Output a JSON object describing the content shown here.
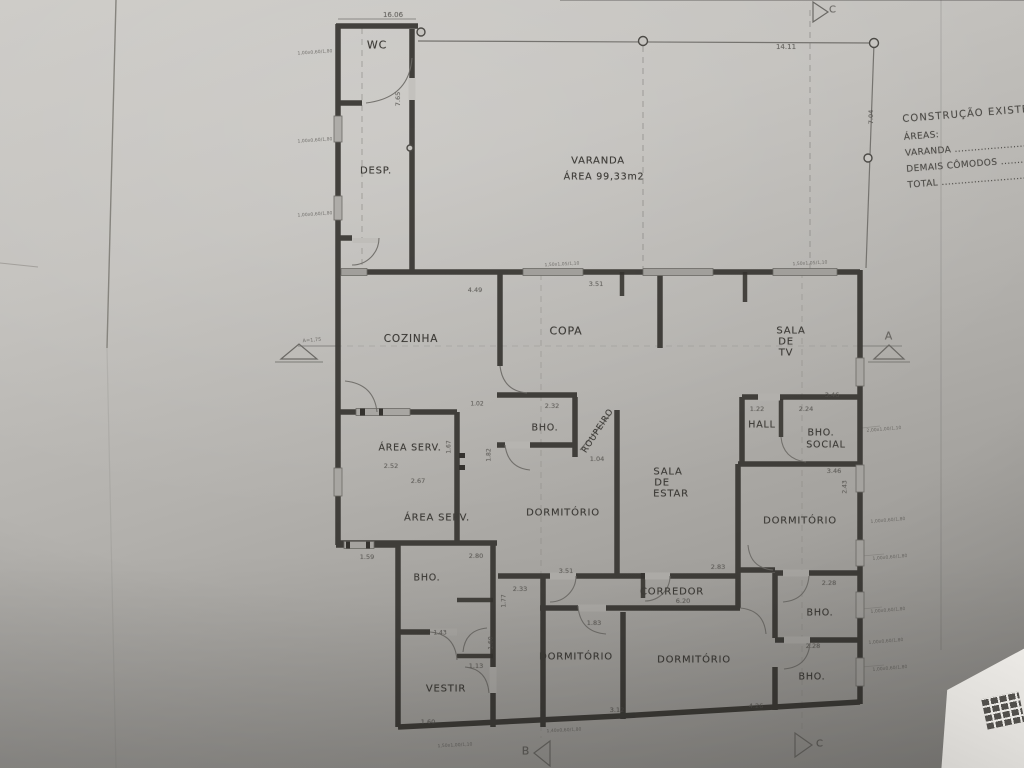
{
  "photo": {
    "subject": "architectural floor plan photographed on gray paper",
    "paper_color": "#b3b1ad",
    "wall_color": "#34322e",
    "white_corner_color": "#ece9e5"
  },
  "notes": {
    "title": "CONSTRUÇÃO EXISTENTE",
    "areas_label": "ÁREAS:",
    "line_varanda": "VARANDA .........................................",
    "line_demais": "DEMAIS CÔMODOS ..................",
    "line_total": "TOTAL ..............................................."
  },
  "labels": [
    {
      "text": "WC",
      "x": 377,
      "y": 45,
      "size": 11,
      "cls": "room",
      "name": "room-label-wc"
    },
    {
      "text": "DESP.",
      "x": 376,
      "y": 171,
      "size": 10,
      "cls": "room",
      "name": "room-label-desp"
    },
    {
      "text": "VARANDA",
      "x": 598,
      "y": 161,
      "size": 10,
      "cls": "room",
      "name": "room-label-varanda"
    },
    {
      "text": "ÁREA 99,33m2",
      "x": 604,
      "y": 177,
      "size": 9.5,
      "cls": "room",
      "name": "varanda-area-value"
    },
    {
      "text": "COZINHA",
      "x": 411,
      "y": 339,
      "size": 10.5,
      "cls": "room",
      "name": "room-label-cozinha"
    },
    {
      "text": "COPA",
      "x": 566,
      "y": 331,
      "size": 11,
      "cls": "room",
      "name": "room-label-copa"
    },
    {
      "text": "SALA",
      "x": 791,
      "y": 331,
      "size": 10,
      "cls": "room",
      "name": "room-label-sala-de-tv"
    },
    {
      "text": "DE",
      "x": 786,
      "y": 342,
      "size": 10,
      "cls": "room",
      "name": "room-label-sala-de-tv"
    },
    {
      "text": "TV",
      "x": 786,
      "y": 353,
      "size": 10,
      "cls": "room",
      "name": "room-label-sala-de-tv"
    },
    {
      "text": "ÁREA SERV.",
      "x": 410,
      "y": 448,
      "size": 9.5,
      "cls": "room",
      "name": "room-label-area-serv-1"
    },
    {
      "text": "BHO.",
      "x": 545,
      "y": 428,
      "size": 9.5,
      "cls": "room",
      "name": "room-label-bho-1"
    },
    {
      "text": "ROUPEIRO",
      "x": 598,
      "y": 431,
      "size": 8.5,
      "rot": -57,
      "cls": "room",
      "name": "room-label-roupeiro"
    },
    {
      "text": "HALL",
      "x": 762,
      "y": 425,
      "size": 9.5,
      "cls": "room",
      "name": "room-label-hall"
    },
    {
      "text": "BHO.",
      "x": 821,
      "y": 433,
      "size": 9.5,
      "cls": "room",
      "name": "room-label-bho-social"
    },
    {
      "text": "SOCIAL",
      "x": 826,
      "y": 445,
      "size": 9.5,
      "cls": "room",
      "name": "room-label-bho-social"
    },
    {
      "text": "SALA",
      "x": 668,
      "y": 472,
      "size": 10,
      "cls": "room",
      "name": "room-label-sala-de-estar"
    },
    {
      "text": "DE",
      "x": 662,
      "y": 483,
      "size": 10,
      "cls": "room",
      "name": "room-label-sala-de-estar"
    },
    {
      "text": "ESTAR",
      "x": 671,
      "y": 494,
      "size": 10,
      "cls": "room",
      "name": "room-label-sala-de-estar"
    },
    {
      "text": "ÁREA SERV.",
      "x": 437,
      "y": 518,
      "size": 10,
      "cls": "room",
      "name": "room-label-area-serv-2"
    },
    {
      "text": "DORMITÓRIO",
      "x": 563,
      "y": 513,
      "size": 10,
      "cls": "room",
      "name": "room-label-dormitorio-1"
    },
    {
      "text": "DORMITÓRIO",
      "x": 800,
      "y": 521,
      "size": 10,
      "cls": "room",
      "name": "room-label-dormitorio-2"
    },
    {
      "text": "BHO.",
      "x": 427,
      "y": 578,
      "size": 9.5,
      "cls": "room",
      "name": "room-label-bho-2"
    },
    {
      "text": "CORREDOR",
      "x": 672,
      "y": 592,
      "size": 10,
      "cls": "room",
      "name": "room-label-corredor"
    },
    {
      "text": "DORMITÓRIO",
      "x": 576,
      "y": 657,
      "size": 10,
      "cls": "room",
      "name": "room-label-dormitorio-3"
    },
    {
      "text": "DORMITÓRIO",
      "x": 694,
      "y": 660,
      "size": 10,
      "cls": "room",
      "name": "room-label-dormitorio-4"
    },
    {
      "text": "BHO.",
      "x": 820,
      "y": 613,
      "size": 9.5,
      "cls": "room",
      "name": "room-label-bho-3"
    },
    {
      "text": "BHO.",
      "x": 812,
      "y": 677,
      "size": 9.5,
      "cls": "room",
      "name": "room-label-bho-4"
    },
    {
      "text": "VESTIR",
      "x": 446,
      "y": 689,
      "size": 10,
      "cls": "room",
      "name": "room-label-vestir"
    },
    {
      "text": "16.06",
      "x": 393,
      "y": 15,
      "size": 7,
      "cls": "dim",
      "name": "dimension-label"
    },
    {
      "text": "7.65",
      "x": 398,
      "y": 99,
      "size": 6.5,
      "rot": -90,
      "cls": "dim",
      "name": "dimension-label"
    },
    {
      "text": "14.11",
      "x": 786,
      "y": 47,
      "size": 7,
      "cls": "dim",
      "name": "dimension-label"
    },
    {
      "text": "7.04",
      "x": 871,
      "y": 117,
      "size": 6.5,
      "rot": -90,
      "cls": "dim",
      "name": "dimension-label"
    },
    {
      "text": "4.49",
      "x": 475,
      "y": 290,
      "size": 6.5,
      "cls": "dim",
      "name": "dimension-label"
    },
    {
      "text": "3.51",
      "x": 596,
      "y": 284,
      "size": 6.5,
      "cls": "dim",
      "name": "dimension-label"
    },
    {
      "text": "2.32",
      "x": 552,
      "y": 406,
      "size": 6.5,
      "cls": "dim",
      "name": "dimension-label"
    },
    {
      "text": "1.04",
      "x": 597,
      "y": 459,
      "size": 6.5,
      "cls": "dim",
      "name": "dimension-label"
    },
    {
      "text": "1.02",
      "x": 477,
      "y": 404,
      "size": 6,
      "cls": "dim",
      "name": "dimension-label"
    },
    {
      "text": "1.82",
      "x": 489,
      "y": 455,
      "size": 6,
      "rot": -90,
      "cls": "dim",
      "name": "dimension-label"
    },
    {
      "text": "1.67",
      "x": 449,
      "y": 447,
      "size": 6,
      "rot": -90,
      "cls": "dim",
      "name": "dimension-label"
    },
    {
      "text": "2.52",
      "x": 391,
      "y": 466,
      "size": 6.5,
      "cls": "dim",
      "name": "dimension-label"
    },
    {
      "text": "2.67",
      "x": 418,
      "y": 481,
      "size": 6.5,
      "cls": "dim",
      "name": "dimension-label"
    },
    {
      "text": "1.22",
      "x": 757,
      "y": 409,
      "size": 6.5,
      "cls": "dim",
      "name": "dimension-label"
    },
    {
      "text": "2.24",
      "x": 806,
      "y": 409,
      "size": 6.5,
      "cls": "dim",
      "name": "dimension-label"
    },
    {
      "text": "3.46",
      "x": 832,
      "y": 395,
      "size": 6.5,
      "cls": "dim",
      "name": "dimension-label"
    },
    {
      "text": "3.46",
      "x": 834,
      "y": 471,
      "size": 6.5,
      "cls": "dim",
      "name": "dimension-label"
    },
    {
      "text": "2.83",
      "x": 718,
      "y": 567,
      "size": 6.5,
      "cls": "dim",
      "name": "dimension-label"
    },
    {
      "text": "2.80",
      "x": 476,
      "y": 556,
      "size": 6.5,
      "cls": "dim",
      "name": "dimension-label"
    },
    {
      "text": "3.51",
      "x": 566,
      "y": 571,
      "size": 6.5,
      "cls": "dim",
      "name": "dimension-label"
    },
    {
      "text": "2.33",
      "x": 520,
      "y": 589,
      "size": 6.5,
      "cls": "dim",
      "name": "dimension-label"
    },
    {
      "text": "1.77",
      "x": 504,
      "y": 601,
      "size": 6,
      "rot": -90,
      "cls": "dim",
      "name": "dimension-label"
    },
    {
      "text": "1.83",
      "x": 594,
      "y": 623,
      "size": 6.5,
      "cls": "dim",
      "name": "dimension-label"
    },
    {
      "text": "6.20",
      "x": 683,
      "y": 601,
      "size": 6.5,
      "cls": "dim",
      "name": "dimension-label"
    },
    {
      "text": "2.28",
      "x": 829,
      "y": 583,
      "size": 6.5,
      "cls": "dim",
      "name": "dimension-label"
    },
    {
      "text": "2.28",
      "x": 813,
      "y": 646,
      "size": 6.5,
      "cls": "dim",
      "name": "dimension-label"
    },
    {
      "text": "4.26",
      "x": 756,
      "y": 706,
      "size": 6.5,
      "cls": "dim",
      "name": "dimension-label"
    },
    {
      "text": "3.12",
      "x": 617,
      "y": 710,
      "size": 6.5,
      "cls": "dim",
      "name": "dimension-label"
    },
    {
      "text": "1.13",
      "x": 476,
      "y": 666,
      "size": 6.5,
      "cls": "dim",
      "name": "dimension-label"
    },
    {
      "text": "1.60",
      "x": 491,
      "y": 643,
      "size": 6,
      "rot": -90,
      "cls": "dim",
      "name": "dimension-label"
    },
    {
      "text": "1.43",
      "x": 440,
      "y": 633,
      "size": 6,
      "cls": "dim",
      "name": "dimension-label"
    },
    {
      "text": "1.59",
      "x": 367,
      "y": 557,
      "size": 6.5,
      "cls": "dim",
      "name": "dimension-label"
    },
    {
      "text": "1.60",
      "x": 428,
      "y": 722,
      "size": 6.5,
      "cls": "dim",
      "name": "dimension-label"
    },
    {
      "text": "2.43",
      "x": 845,
      "y": 487,
      "size": 6,
      "rot": -90,
      "cls": "dim",
      "name": "dimension-label"
    },
    {
      "text": "1,00x0,60/1,80",
      "x": 315,
      "y": 52,
      "size": 8,
      "sc": 0.55,
      "rot": -4,
      "cls": "ann",
      "name": "window-annotation"
    },
    {
      "text": "1,00x0,60/1,80",
      "x": 315,
      "y": 140,
      "size": 8,
      "sc": 0.55,
      "rot": -4,
      "cls": "ann",
      "name": "window-annotation"
    },
    {
      "text": "1,00x0,60/1,80",
      "x": 315,
      "y": 214,
      "size": 8,
      "sc": 0.55,
      "rot": -4,
      "cls": "ann",
      "name": "window-annotation"
    },
    {
      "text": "1,50x1,05/1,10",
      "x": 562,
      "y": 264,
      "size": 8,
      "sc": 0.55,
      "rot": -3,
      "cls": "ann",
      "name": "window-annotation"
    },
    {
      "text": "1,50x1,05/1,10",
      "x": 810,
      "y": 263,
      "size": 8,
      "sc": 0.55,
      "rot": -3,
      "cls": "ann",
      "name": "window-annotation"
    },
    {
      "text": "2,00x1,00/1,10",
      "x": 884,
      "y": 429,
      "size": 8,
      "sc": 0.55,
      "rot": -5,
      "cls": "ann",
      "name": "window-annotation"
    },
    {
      "text": "1,00x0,60/1,80",
      "x": 888,
      "y": 520,
      "size": 8,
      "sc": 0.55,
      "rot": -5,
      "cls": "ann",
      "name": "window-annotation"
    },
    {
      "text": "1,00x0,60/1,80",
      "x": 890,
      "y": 557,
      "size": 8,
      "sc": 0.55,
      "rot": -5,
      "cls": "ann",
      "name": "window-annotation"
    },
    {
      "text": "1,00x0,60/1,80",
      "x": 888,
      "y": 610,
      "size": 8,
      "sc": 0.55,
      "rot": -5,
      "cls": "ann",
      "name": "window-annotation"
    },
    {
      "text": "1,00x0,60/1,80",
      "x": 886,
      "y": 641,
      "size": 8,
      "sc": 0.55,
      "rot": -5,
      "cls": "ann",
      "name": "window-annotation"
    },
    {
      "text": "1,00x0,60/1,80",
      "x": 890,
      "y": 668,
      "size": 8,
      "sc": 0.55,
      "rot": -5,
      "cls": "ann",
      "name": "window-annotation"
    },
    {
      "text": "1,40x0,60/1,80",
      "x": 564,
      "y": 730,
      "size": 8,
      "sc": 0.55,
      "rot": -3,
      "cls": "ann",
      "name": "window-annotation"
    },
    {
      "text": "1,50x1,00/1,10",
      "x": 455,
      "y": 745,
      "size": 8,
      "sc": 0.55,
      "rot": -3,
      "cls": "ann",
      "name": "window-annotation"
    },
    {
      "text": "A=1,75",
      "x": 312,
      "y": 340,
      "size": 8,
      "sc": 0.6,
      "rot": -5,
      "cls": "ann",
      "name": "section-note"
    },
    {
      "text": "A",
      "x": 889,
      "y": 336,
      "size": 11,
      "cls": "mark",
      "name": "section-marker-label-a"
    },
    {
      "text": "B",
      "x": 526,
      "y": 751,
      "size": 11,
      "cls": "mark",
      "name": "section-marker-label-b"
    },
    {
      "text": "C",
      "x": 820,
      "y": 744,
      "size": 10,
      "cls": "mark",
      "name": "section-marker-label-c"
    },
    {
      "text": "C",
      "x": 833,
      "y": 10,
      "size": 10,
      "cls": "mark",
      "name": "section-marker-label-c-top"
    }
  ]
}
